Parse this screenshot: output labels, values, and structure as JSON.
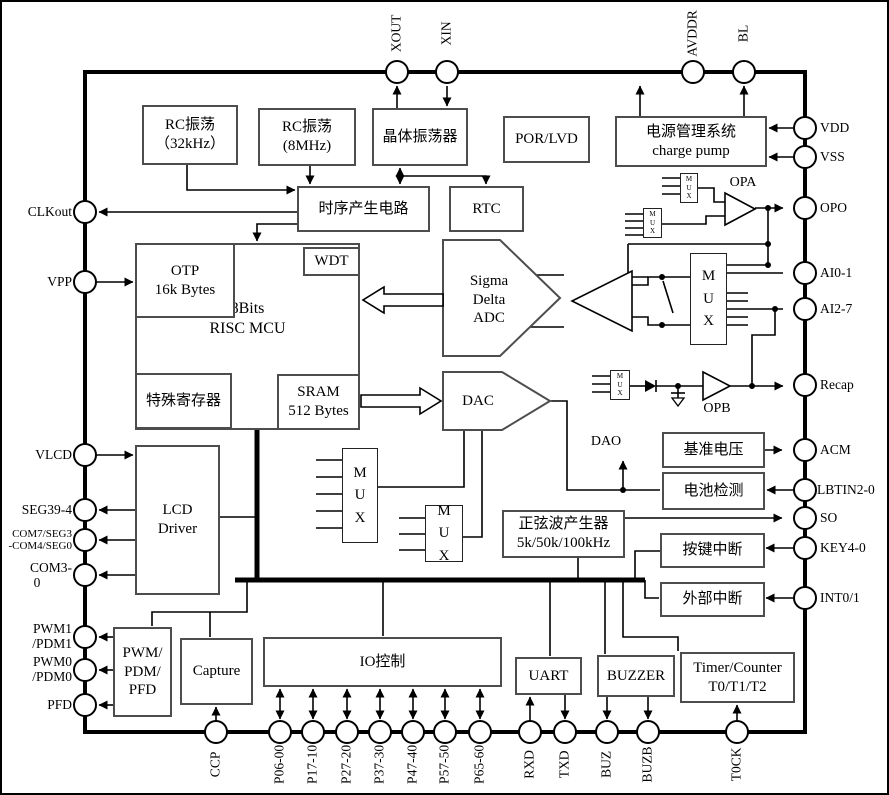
{
  "diagram_title": "MCU block diagram",
  "pins": {
    "top": [
      {
        "label": "XOUT"
      },
      {
        "label": "XIN"
      },
      {
        "label": "AVDDR"
      },
      {
        "label": "BL"
      }
    ],
    "right": [
      {
        "label": "VDD"
      },
      {
        "label": "VSS"
      },
      {
        "label": "OPO"
      },
      {
        "label": "AI0-1"
      },
      {
        "label": "AI2-7"
      },
      {
        "label": "Recap"
      },
      {
        "label": "ACM"
      },
      {
        "label": "LBTIN2-0"
      },
      {
        "label": "SO"
      },
      {
        "label": "KEY4-0"
      },
      {
        "label": "INT0/1"
      }
    ],
    "left": [
      {
        "label": "CLKout"
      },
      {
        "label": "VPP"
      },
      {
        "label": "VLCD"
      },
      {
        "label": "SEG39-4"
      },
      {
        "label": "COM7/SEG3",
        "label2": "-COM4/SEG0"
      },
      {
        "label": "COM3-",
        "label2": "0"
      },
      {
        "label": "PWM1",
        "label2": "/PDM1"
      },
      {
        "label": "PWM0",
        "label2": "/PDM0"
      },
      {
        "label": "PFD"
      }
    ],
    "bottom": [
      {
        "label": "CCP"
      },
      {
        "label": "P06-00"
      },
      {
        "label": "P17-10"
      },
      {
        "label": "P27-20"
      },
      {
        "label": "P37-30"
      },
      {
        "label": "P47-40"
      },
      {
        "label": "P57-50"
      },
      {
        "label": "P65-60"
      },
      {
        "label": "RXD"
      },
      {
        "label": "TXD"
      },
      {
        "label": "BUZ"
      },
      {
        "label": "BUZB"
      },
      {
        "label": "T0CK"
      }
    ]
  },
  "blocks": {
    "rc32k": {
      "lines": [
        "RC振荡",
        "（32kHz）"
      ]
    },
    "rc8m": {
      "lines": [
        "RC振荡",
        "(8MHz)"
      ]
    },
    "crystal": {
      "lines": [
        "晶体振荡器"
      ]
    },
    "porlvd": {
      "lines": [
        "POR/LVD"
      ]
    },
    "power": {
      "lines": [
        "电源管理系统",
        "charge pump"
      ]
    },
    "timing": {
      "lines": [
        "时序产生电路"
      ]
    },
    "rtc": {
      "lines": [
        "RTC"
      ]
    },
    "mcu": {
      "lines": [
        "8Bits",
        "RISC  MCU"
      ]
    },
    "otp": {
      "lines": [
        "OTP",
        "16k Bytes"
      ]
    },
    "wdt": {
      "lines": [
        "WDT"
      ]
    },
    "sfr": {
      "lines": [
        "特殊寄存器"
      ]
    },
    "sram": {
      "lines": [
        "SRAM",
        "512 Bytes"
      ]
    },
    "adc": {
      "lines": [
        "Sigma",
        "Delta",
        "ADC"
      ]
    },
    "dac": {
      "lines": [
        "DAC"
      ]
    },
    "lcd": {
      "lines": [
        "LCD",
        "Driver"
      ]
    },
    "sine": {
      "lines": [
        "正弦波产生器",
        "5k/50k/100kHz"
      ]
    },
    "vref": {
      "lines": [
        "基准电压"
      ]
    },
    "batdet": {
      "lines": [
        "电池检测"
      ]
    },
    "keyint": {
      "lines": [
        "按键中断"
      ]
    },
    "extint": {
      "lines": [
        "外部中断"
      ]
    },
    "pwm": {
      "lines": [
        "PWM/",
        "PDM/",
        "PFD"
      ]
    },
    "capture": {
      "lines": [
        "Capture"
      ]
    },
    "io": {
      "lines": [
        "IO控制"
      ]
    },
    "uart": {
      "lines": [
        "UART"
      ]
    },
    "buzzer": {
      "lines": [
        "BUZZER"
      ]
    },
    "timer": {
      "lines": [
        "Timer/Counter",
        "T0/T1/T2"
      ]
    }
  },
  "misc": {
    "mux": [
      "M",
      "U",
      "X"
    ],
    "opa": "OPA",
    "opb": "OPB",
    "dao": "DAO",
    "colors": {
      "wire": "#000000",
      "block_border": "#4d4d4d",
      "background": "#ffffff"
    }
  }
}
